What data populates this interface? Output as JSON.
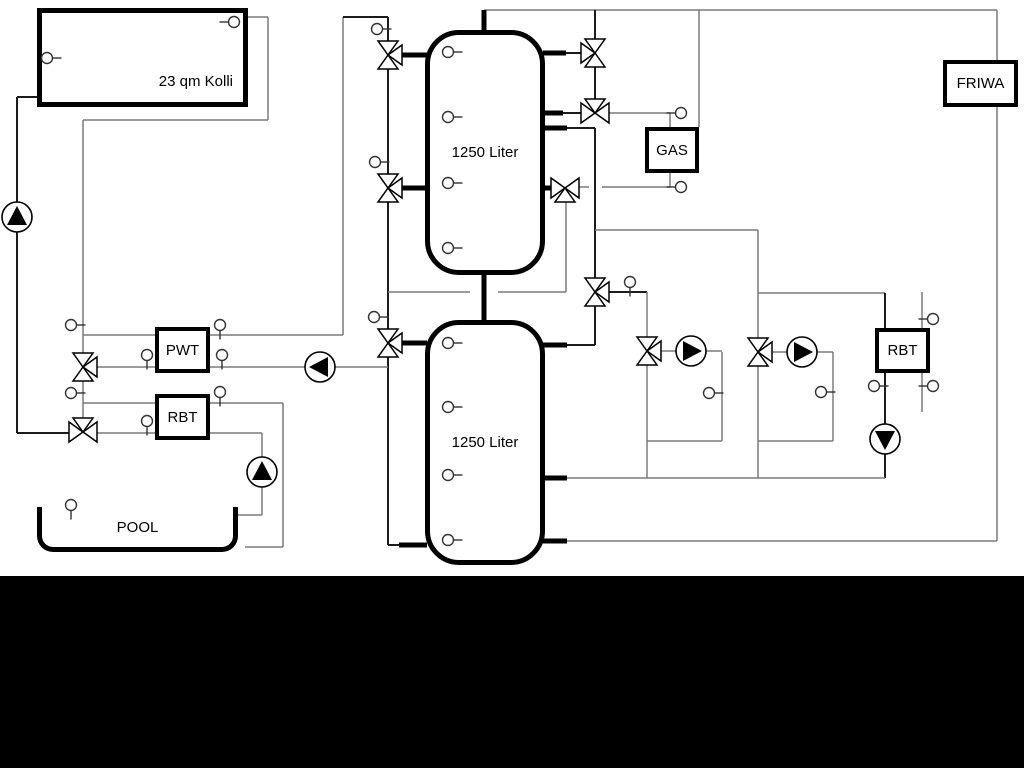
{
  "diagram": {
    "type": "hydraulic-heating-schematic",
    "background": "#ffffff",
    "colors": {
      "line_gray": "#7a7a7a",
      "line_black": "#1c1c1c",
      "outline": "#000000",
      "bottom_bar": "#000000"
    },
    "equipment": {
      "collector": {
        "label": "23 qm Kolli"
      },
      "buffer_tank_top": {
        "label": "1250 Liter"
      },
      "buffer_tank_bottom": {
        "label": "1250 Liter"
      },
      "gas_boiler": {
        "label": "GAS"
      },
      "friwa_station": {
        "label": "FRIWA"
      },
      "pwt_exchanger": {
        "label": "PWT"
      },
      "rbt_left": {
        "label": "RBT"
      },
      "rbt_right": {
        "label": "RBT"
      },
      "pool": {
        "label": "POOL"
      }
    },
    "components": {
      "pumps": [
        {
          "name": "solar-pump",
          "direction": "up"
        },
        {
          "name": "pool-pump",
          "direction": "up"
        },
        {
          "name": "pool-circuit-pump",
          "direction": "left"
        },
        {
          "name": "heating-pump-1",
          "direction": "right"
        },
        {
          "name": "heating-pump-2",
          "direction": "right"
        },
        {
          "name": "return-pump",
          "direction": "down"
        }
      ],
      "valve_count": 11,
      "sensor_count": 29
    }
  }
}
